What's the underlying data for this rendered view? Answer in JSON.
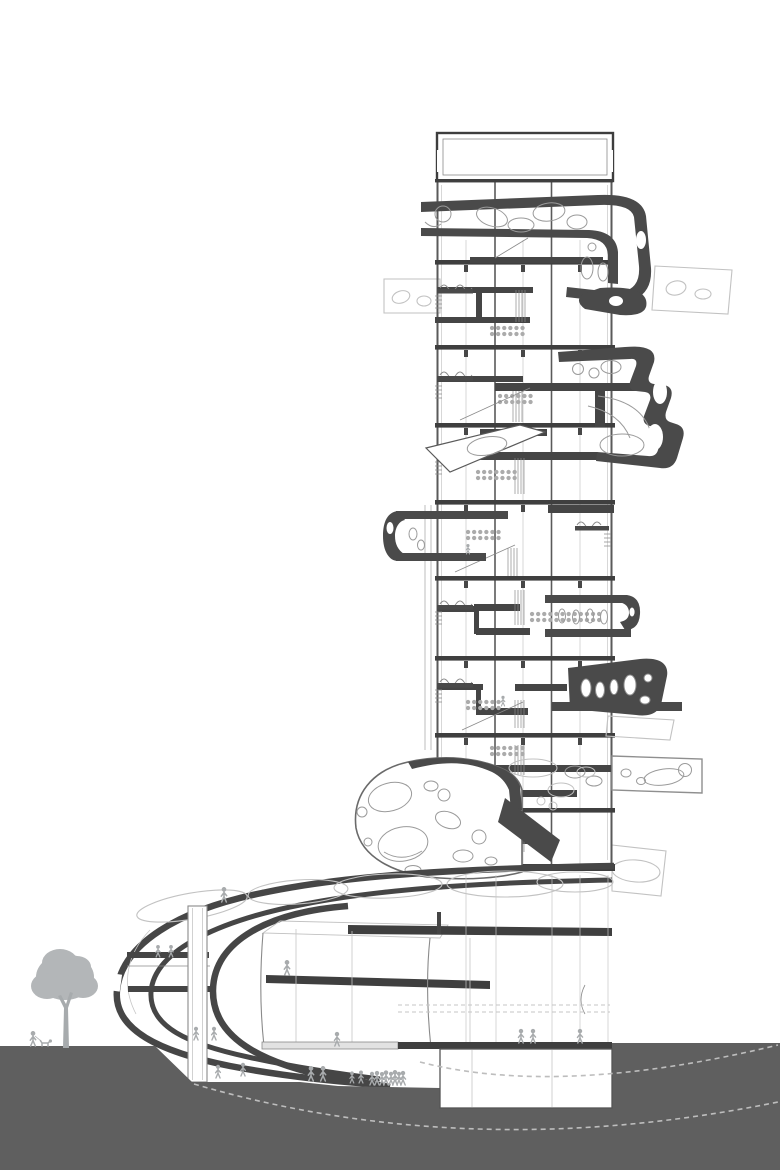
{
  "scene": {
    "description": "Black-and-white architectural cross-section drawing of a slender residential tower with perforated organic pod volumes attached at several levels, standing on a large curved podium base that wraps into a sunken plaza; gray ground mass below with dashed excavation arcs, a tree, and small human silhouettes for scale",
    "drawing_type": "building section / elevation",
    "tower": {
      "major_floor_slabs": 9,
      "bays": 3,
      "has_stairs": true,
      "pod_volumes": 7
    },
    "podium": {
      "form": "curved wing with nose at left",
      "hall_volume": true,
      "elevator_shaft": true,
      "skylight_ovals": 5
    },
    "site": {
      "tree_count": 1,
      "figure_count_approx": 30,
      "dashed_arcs": 2,
      "basement_box": true,
      "sunken_plaza": true
    }
  },
  "colors": {
    "paper": "#ffffff",
    "slab": "#3f3f3f",
    "pod_fill": "#4a4a4a",
    "ground": "#5f5f5f",
    "figure": "#a8abad",
    "tree": "#b3b6b8",
    "dashed": "#bdbdbd",
    "ghost": "#c2c2c2",
    "line_mid": "#8a8a8a"
  }
}
